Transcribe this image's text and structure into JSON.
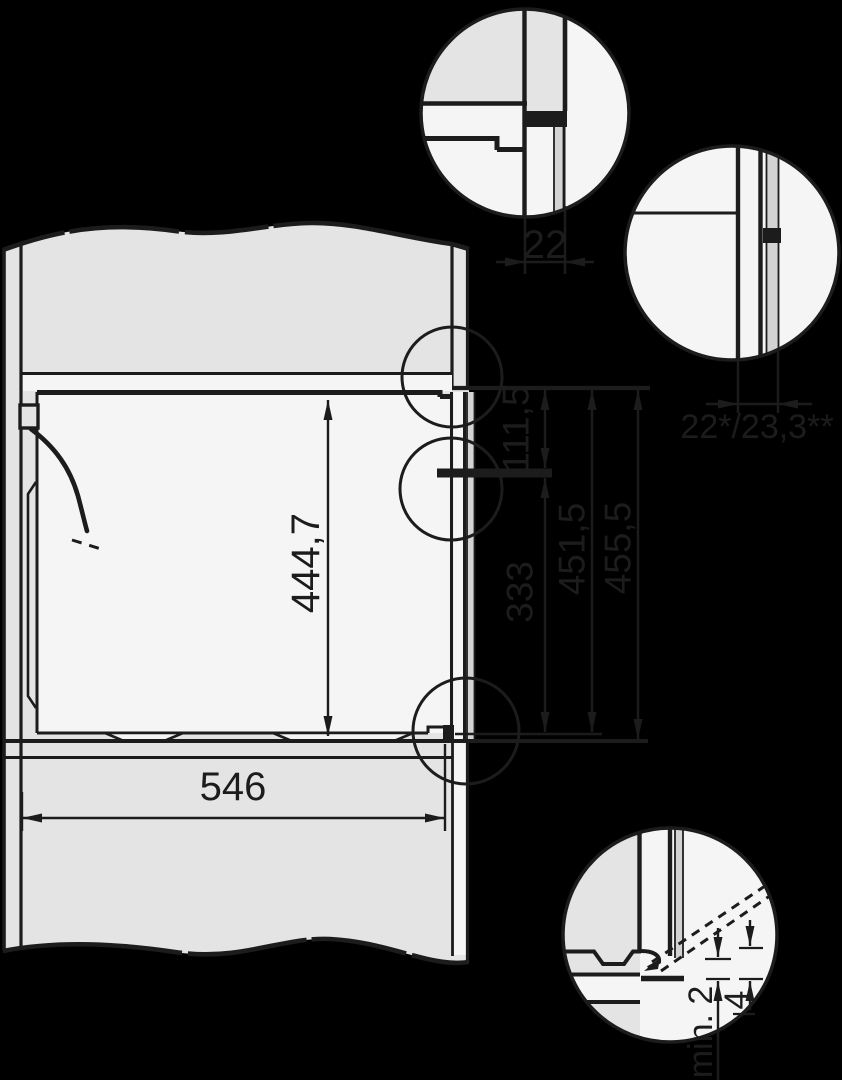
{
  "diagram": {
    "kind": "appliance-niche-installation-cross-section",
    "dimensions": {
      "top_wall_thickness": "22",
      "front_wall_thickness": "22*/23,3**",
      "upper_recess_height": "111,5",
      "niche_inner_height": "444,7",
      "lower_recess_height": "333",
      "recess_height_total_1": "451,5",
      "recess_height_total_2": "455,5",
      "niche_width": "546",
      "bottom_min_clearance": "min. 2",
      "bottom_front_offset": "4"
    }
  },
  "colors": {
    "background": "#000000",
    "ink": "#1c1c1c",
    "body": "#e4e4e4",
    "light": "#f5f5f5",
    "trim": "#d3d3d3"
  }
}
